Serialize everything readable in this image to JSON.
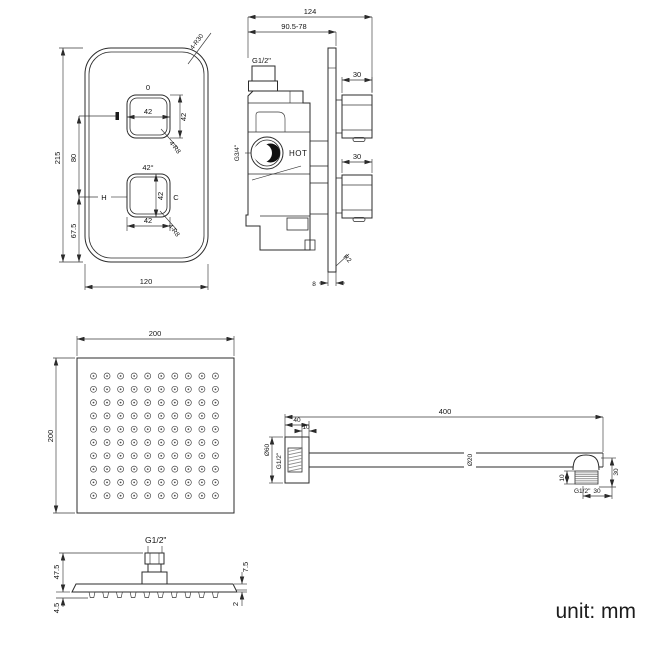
{
  "unit_label": "unit: mm",
  "valve_front": {
    "corner_note": "4-R30",
    "dim_height": "215",
    "dim_width": "120",
    "dim_knob_spacing": "80",
    "dim_bottom_offset": "67.5",
    "upper_knob": {
      "top_label": "0",
      "dim_width": "42",
      "dim_height": "42",
      "radius_note": "4-R8"
    },
    "lower_knob": {
      "top_label": "42°",
      "hot_label": "H",
      "cold_label": "C",
      "dim_width": "42",
      "dim_height": "42",
      "radius_note": "4-R8"
    }
  },
  "valve_side": {
    "dim_total_width": "124",
    "dim_depth_range": "90.5-78",
    "top_thread": "G1/2\"",
    "inlet_thread": "G3/4\"",
    "hot_label": "HOT",
    "upper_knob_dim": "30",
    "lower_knob_dim": "30",
    "plate_thickness": "8",
    "plate_corner_note": "R2"
  },
  "head_face": {
    "dim_width": "200",
    "dim_height": "200",
    "grid": {
      "rows": 10,
      "cols": 10
    }
  },
  "arm_side": {
    "dim_length": "400",
    "dim_flange_depth": "40",
    "dim_flange_lip": "10",
    "flange_diameter": "Ø60",
    "wall_thread": "G1/2\"",
    "tube_diameter": "Ø20",
    "tip_thread_length": "10",
    "tip_thread": "G1/2\"",
    "tip_drop": "30",
    "tip_offset": "30"
  },
  "head_side": {
    "thread": "G1/2\"",
    "dim_total_height": "47.5",
    "dim_nozzle_height": "4.5",
    "dim_edge_height": "7.5",
    "dim_panel_thickness": "2",
    "nozzle_count": 10
  }
}
